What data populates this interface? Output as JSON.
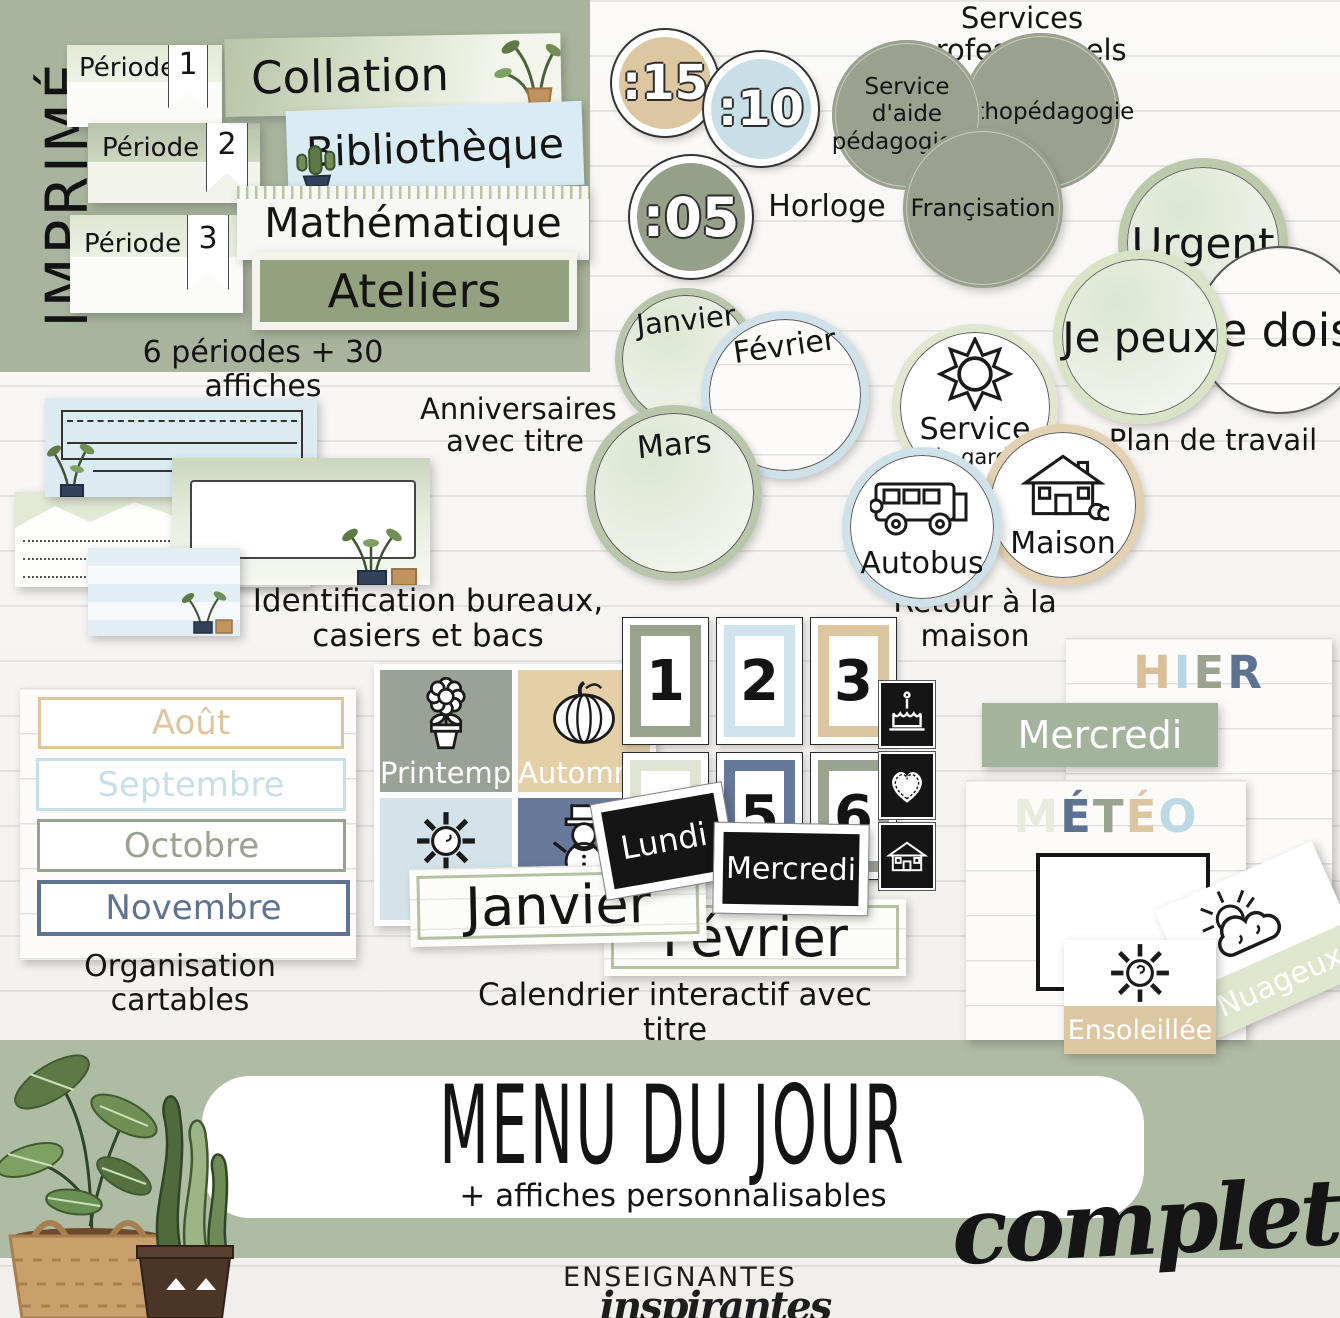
{
  "colors": {
    "sage": "#9aa48f",
    "sage_panel": "#a8b49d",
    "sage_band": "#aebca4",
    "service_circle": "#9aa18e",
    "tan": "#ddc7a0",
    "pale_blue": "#cfe2ea",
    "slate_blue": "#5f7494",
    "black_card": "#151515",
    "mercredi_banner": "#a4b39b"
  },
  "imprime": {
    "label": "IMPRIMÉ",
    "caption": "6 périodes + 30 affiches",
    "periods": [
      {
        "label": "Période",
        "num": "1"
      },
      {
        "label": "Période",
        "num": "2"
      },
      {
        "label": "Période",
        "num": "3"
      }
    ],
    "subjects": [
      "Collation",
      "Bibliothèque",
      "Mathématique",
      "Ateliers"
    ]
  },
  "horloge": {
    "label": "Horloge",
    "values": [
      {
        "text": ":15",
        "color": "#ddc7a1"
      },
      {
        "text": ":10",
        "color": "#c9dfe8"
      },
      {
        "text": ":05",
        "color": "#96a089"
      }
    ]
  },
  "services": {
    "title": "Services professionnels",
    "items": [
      "Service d'aide pédagogique",
      "Orthopédagogie",
      "Françisation"
    ]
  },
  "plan_travail": {
    "caption": "Plan de travail",
    "items": [
      "Urgent",
      "Je peux",
      "Je dois"
    ]
  },
  "anniversaires": {
    "caption_line1": "Anniversaires",
    "caption_line2": "avec titre",
    "months": [
      "Janvier",
      "Février",
      "Mars"
    ]
  },
  "retour": {
    "caption": "Retour à la maison",
    "garde_line1": "Service",
    "garde_line2": "de garde",
    "bus": "Autobus",
    "maison": "Maison"
  },
  "identification": {
    "caption_line1": "Identification bureaux,",
    "caption_line2": "casiers et bacs"
  },
  "organisation": {
    "caption_line1": "Organisation",
    "caption_line2": "cartables",
    "months": [
      {
        "label": "Août",
        "color": "#dfc49d"
      },
      {
        "label": "Septembre",
        "color": "#c6dfe9"
      },
      {
        "label": "Octobre",
        "color": "#98a28c"
      },
      {
        "label": "Novembre",
        "color": "#5e7394"
      }
    ]
  },
  "saisons": [
    {
      "label": "Printemps",
      "color": "#99a295",
      "icon": "flower-pot-icon"
    },
    {
      "label": "Automne",
      "color": "#e4cfa6",
      "icon": "pumpkin-icon"
    },
    {
      "label": "Été",
      "color": "#d4e3ea",
      "icon": "sun-icon"
    },
    {
      "label": "Hiver",
      "color": "#69799a",
      "icon": "snowman-icon"
    }
  ],
  "calendrier": {
    "caption": "Calendrier interactif avec titre",
    "numbers": [
      "1",
      "2",
      "3",
      "4",
      "5",
      "6"
    ],
    "number_colors": [
      "#98a28c",
      "#cfe3eb",
      "#dcc69f",
      "#dfe5d2",
      "#64789b",
      "#99a390"
    ],
    "days": [
      "Lundi",
      "Mercredi"
    ],
    "months": [
      "Janvier",
      "Février"
    ],
    "icon_cards": [
      "cake-icon",
      "heart-icon",
      "house-icon"
    ]
  },
  "jour": {
    "hier_letters": [
      {
        "ch": "H",
        "color": "#d9c096"
      },
      {
        "ch": "I",
        "color": "#b7d6e3"
      },
      {
        "ch": "E",
        "color": "#99a390"
      },
      {
        "ch": "R",
        "color": "#5e7394"
      }
    ],
    "aujourdhui": "Mercredi"
  },
  "meteo": {
    "letters": [
      {
        "ch": "M",
        "color": "#e8ecdc"
      },
      {
        "ch": "É",
        "color": "#5e7394"
      },
      {
        "ch": "T",
        "color": "#99a390"
      },
      {
        "ch": "É",
        "color": "#dcc69f"
      },
      {
        "ch": "O",
        "color": "#bcd9e5"
      }
    ],
    "cards": [
      {
        "label": "Ensoleillée",
        "band_color": "#ddc7a0"
      },
      {
        "label": "Nuageux",
        "band_color": "#dfe6ce"
      }
    ]
  },
  "banner": {
    "title": "MENU DU JOUR",
    "subtitle": "+ affiches personnalisables",
    "script": "complet"
  },
  "logo": {
    "line1": "ENSEIGNANTES",
    "line2": "inspirantes"
  }
}
